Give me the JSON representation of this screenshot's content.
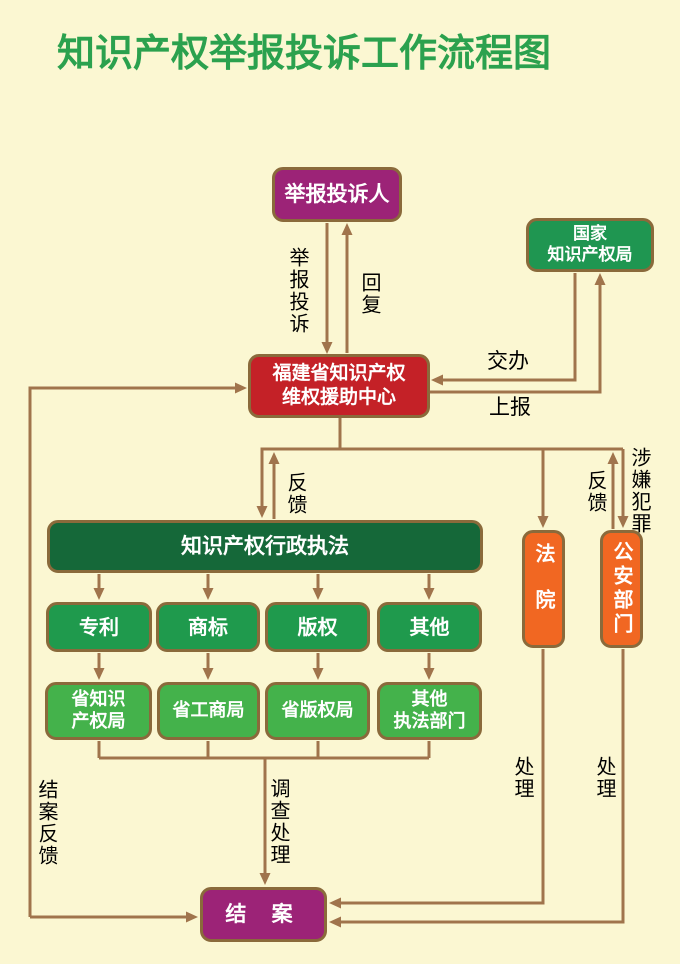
{
  "title": "知识产权举报投诉工作流程图",
  "colors": {
    "background": "#FBF7D2",
    "title_green": "#2BA14E",
    "magenta": "#9C2377",
    "red": "#C42127",
    "green": "#1F9651",
    "medium_green": "#1F9A4D",
    "light_green": "#44B24B",
    "dark_green": "#156839",
    "orange": "#F16722",
    "connector_brown": "#A0744C",
    "box_border_brown": "#8A6A3B",
    "label_text": "#000000"
  },
  "nodes": {
    "reporter": {
      "label": "举报投诉人"
    },
    "national_ip_office": {
      "lines": [
        "国家",
        "知识产权局"
      ]
    },
    "fujian_center": {
      "lines": [
        "福建省知识产权",
        "维权援助中心"
      ]
    },
    "admin_enforcement": {
      "label": "知识产权行政执法"
    },
    "patent": {
      "label": "专利"
    },
    "trademark": {
      "label": "商标"
    },
    "copyright": {
      "label": "版权"
    },
    "other": {
      "label": "其他"
    },
    "provincial_ip_bureau": {
      "lines": [
        "省知识",
        "产权局"
      ]
    },
    "provincial_aic": {
      "label": "省工商局"
    },
    "provincial_copyright_bureau": {
      "label": "省版权局"
    },
    "other_enforcement_depts": {
      "lines": [
        "其他",
        "执法部门"
      ]
    },
    "court": {
      "label": "法院"
    },
    "police": {
      "label": "公安部门"
    },
    "case_closed": {
      "label": "结 案"
    }
  },
  "edge_labels": {
    "report_complaint": "举报投诉",
    "reply": "回复",
    "assign": "交办",
    "report_up": "上报",
    "feedback_left": "反馈",
    "feedback_right": "反馈",
    "suspected_crime": "涉嫌犯罪",
    "investigate_handle": "调查处理",
    "handle_court": "处理",
    "handle_police": "处理",
    "case_closure_feedback": "结案反馈"
  }
}
